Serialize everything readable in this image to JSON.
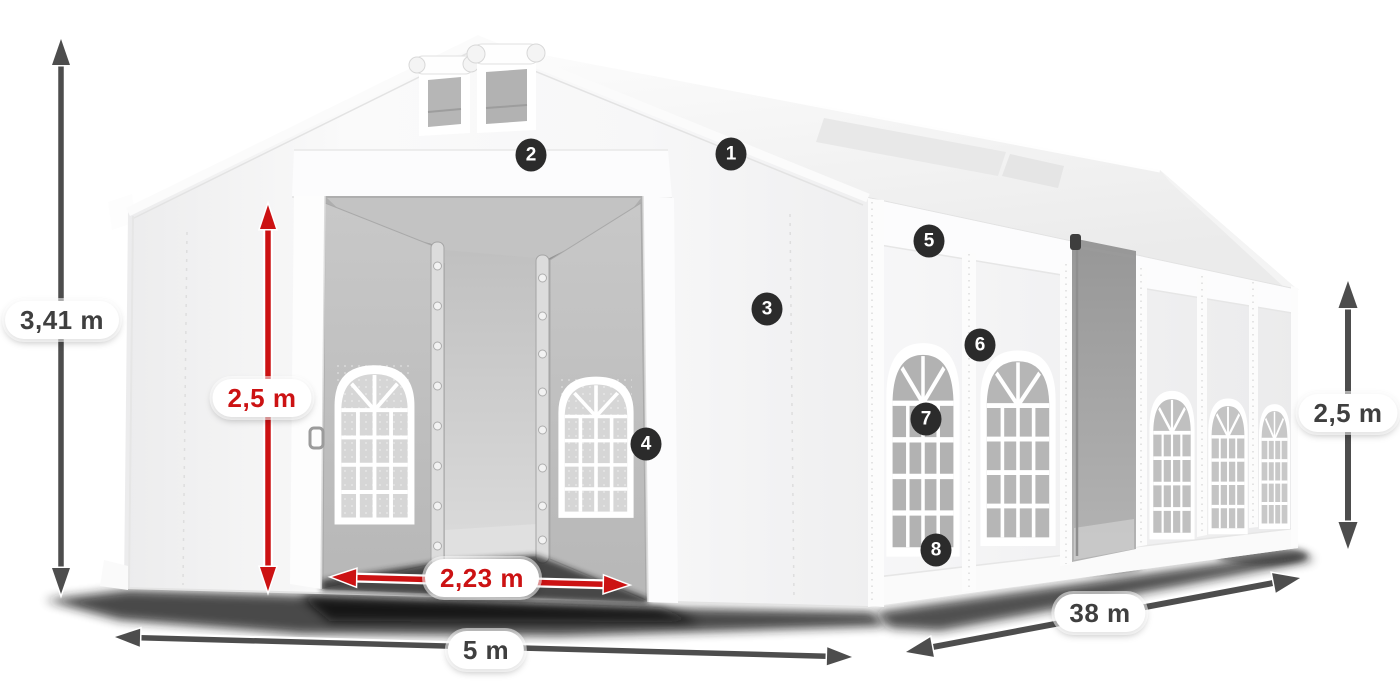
{
  "dimensions": {
    "total_height": {
      "label": "3,41 m",
      "style": "dark"
    },
    "door_height": {
      "label": "2,5 m",
      "style": "red"
    },
    "door_width": {
      "label": "2,23 m",
      "style": "red"
    },
    "front_width": {
      "label": "5 m",
      "style": "dark"
    },
    "length": {
      "label": "38 m",
      "style": "dark"
    },
    "side_height": {
      "label": "2,5 m",
      "style": "dark"
    }
  },
  "markers": [
    {
      "label": "1"
    },
    {
      "label": "2"
    },
    {
      "label": "3"
    },
    {
      "label": "4"
    },
    {
      "label": "5"
    },
    {
      "label": "6"
    },
    {
      "label": "7"
    },
    {
      "label": "8"
    }
  ],
  "colors": {
    "dimension_dark": "#4d4d4d",
    "dimension_red": "#cc1213",
    "marker_bg": "#2b2b2b",
    "marker_text": "#ffffff",
    "label_bg": "#ffffff",
    "label_text_dark": "#3f3f3f",
    "tent_white": "#f7f7f8",
    "mesh_gray": "#b2b2b2",
    "shadow": "#1b1b1b"
  }
}
